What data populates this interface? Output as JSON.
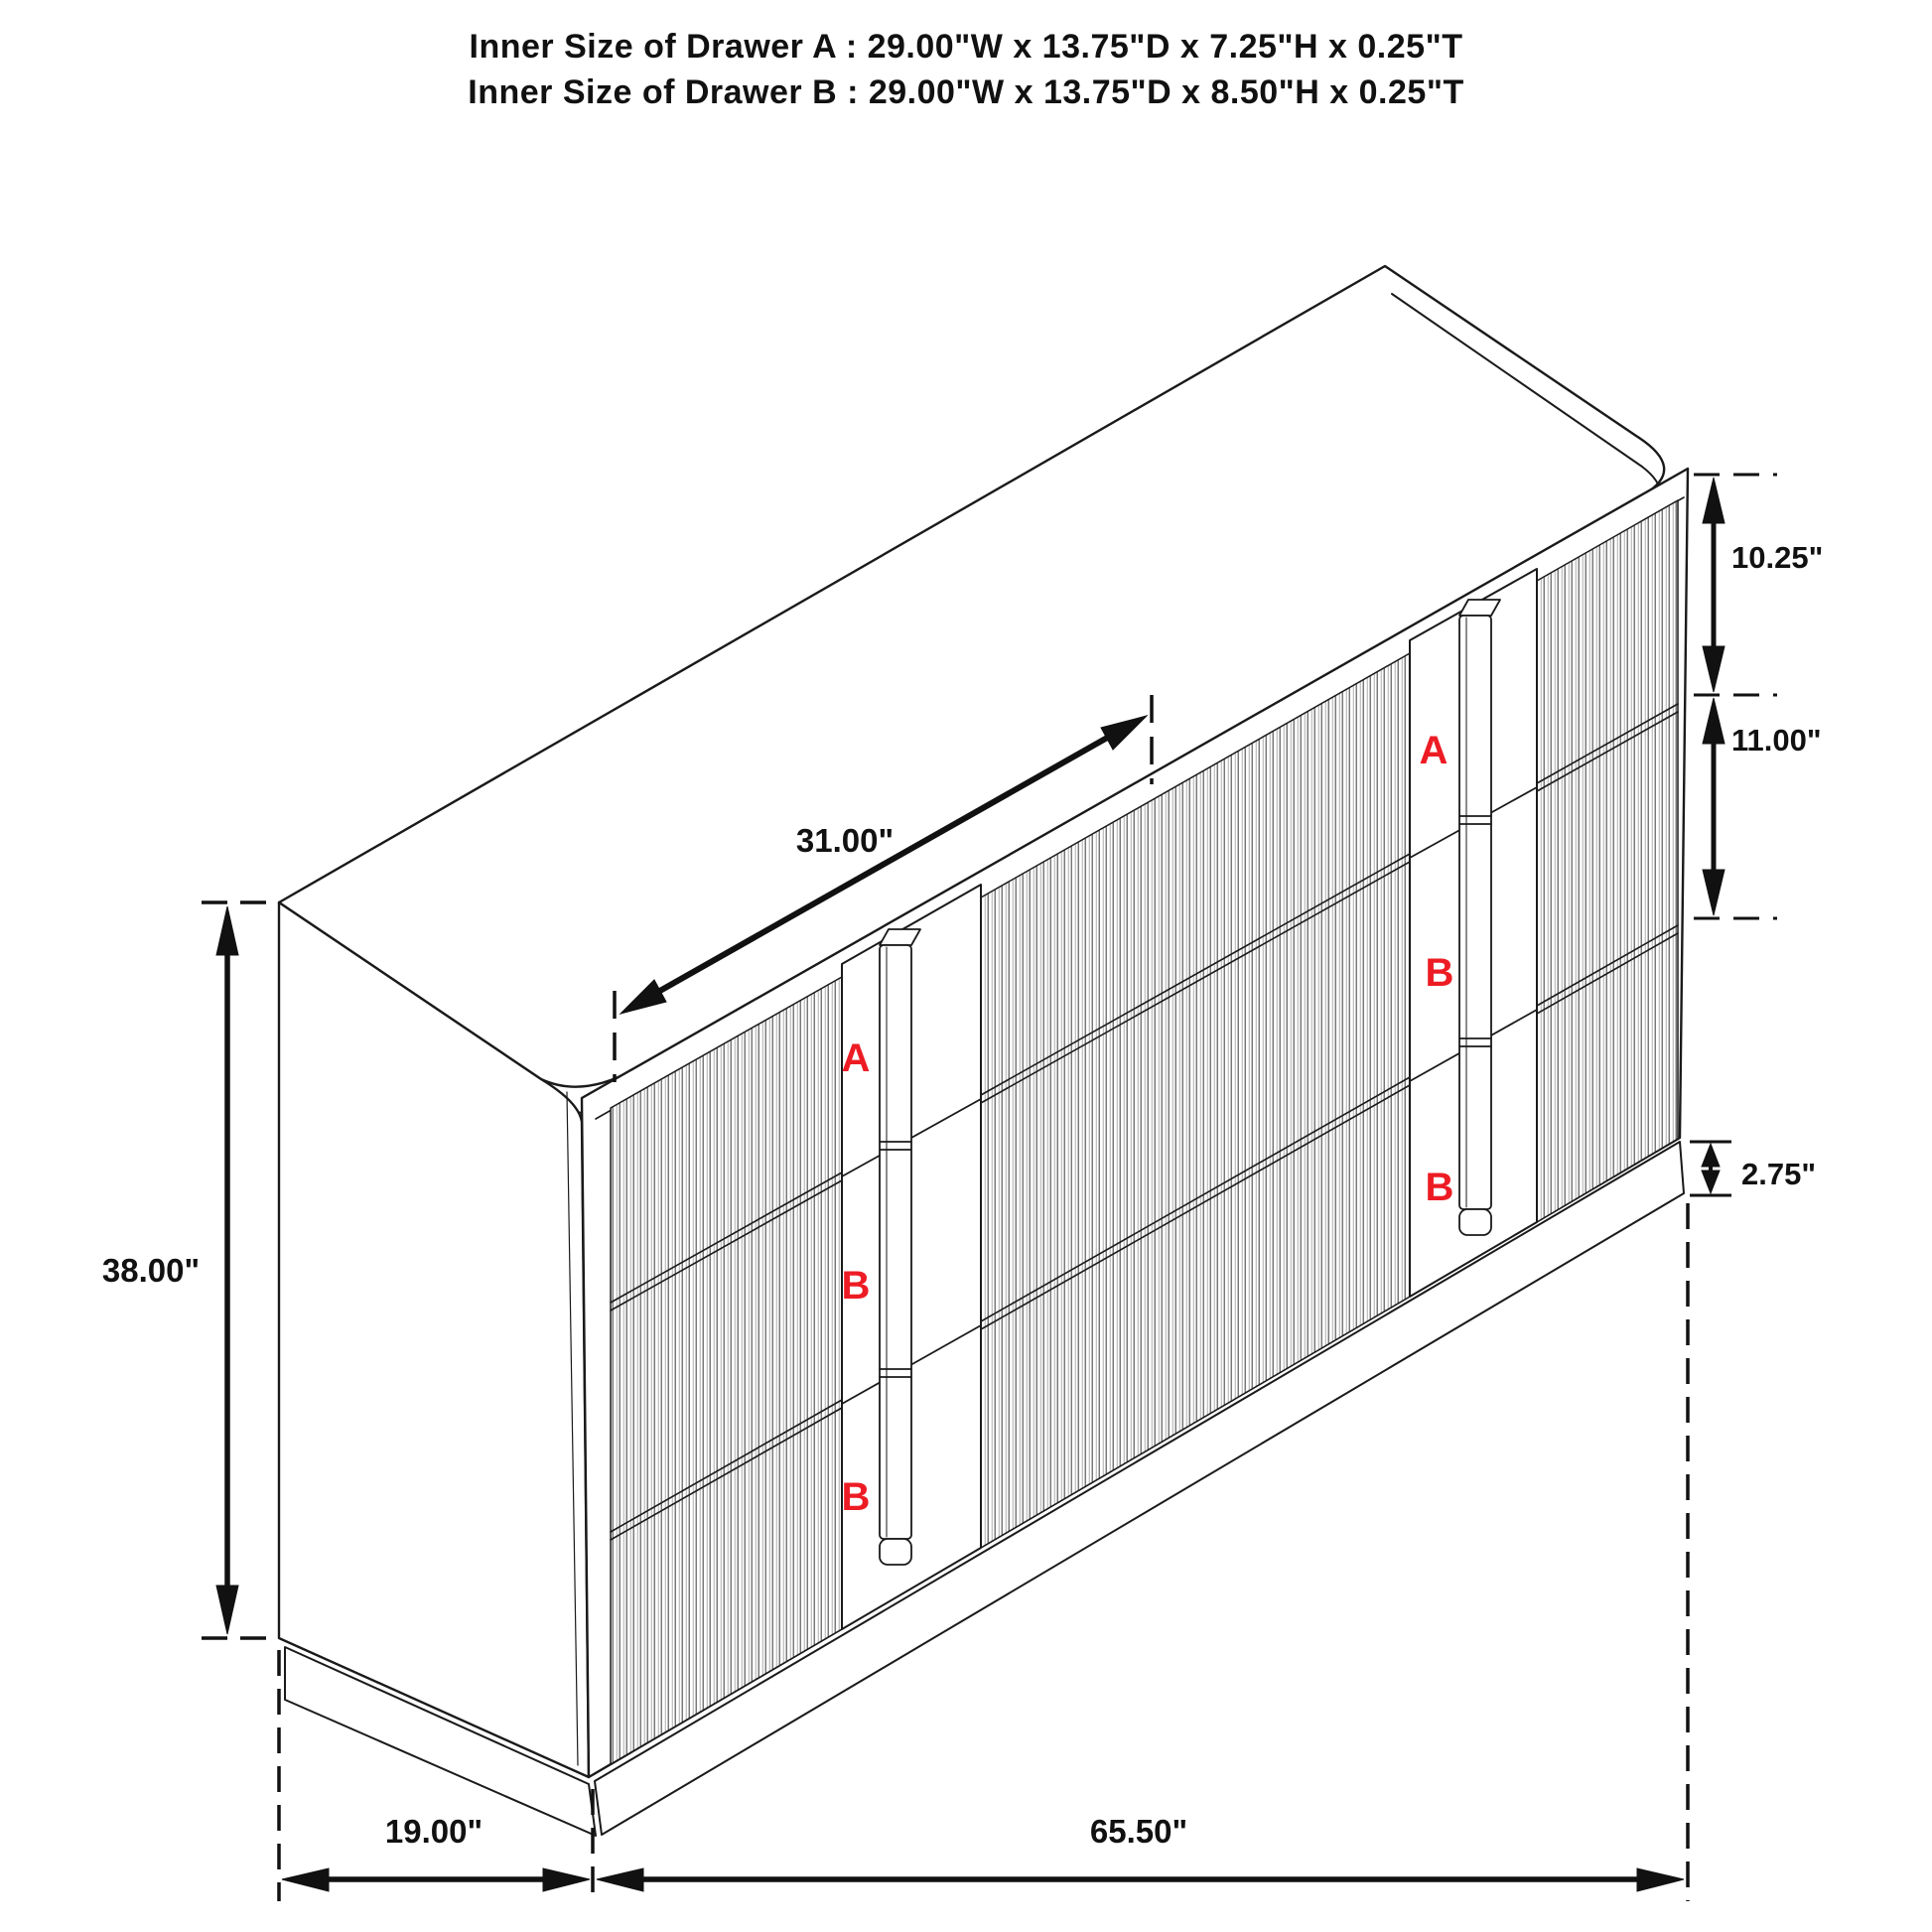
{
  "title": {
    "line1": "Inner Size of Drawer A : 29.00\"W x 13.75\"D x 7.25\"H x 0.25\"T",
    "line2": "Inner Size of Drawer B : 29.00\"W x 13.75\"D x 8.50\"H x 0.25\"T"
  },
  "dimensions": {
    "total_height": "38.00\"",
    "total_width": "65.50\"",
    "side_depth": "19.00\"",
    "top_drawer_width": "31.00\"",
    "drawer_a_height": "10.25\"",
    "drawer_b_height": "11.00\"",
    "base_height": "2.75\""
  },
  "drawer_labels": {
    "left": [
      "A",
      "B",
      "B"
    ],
    "right": [
      "A",
      "B",
      "B"
    ]
  },
  "colors": {
    "line": "#1a1a1a",
    "label_red": "#ed1c24",
    "background": "#ffffff"
  }
}
